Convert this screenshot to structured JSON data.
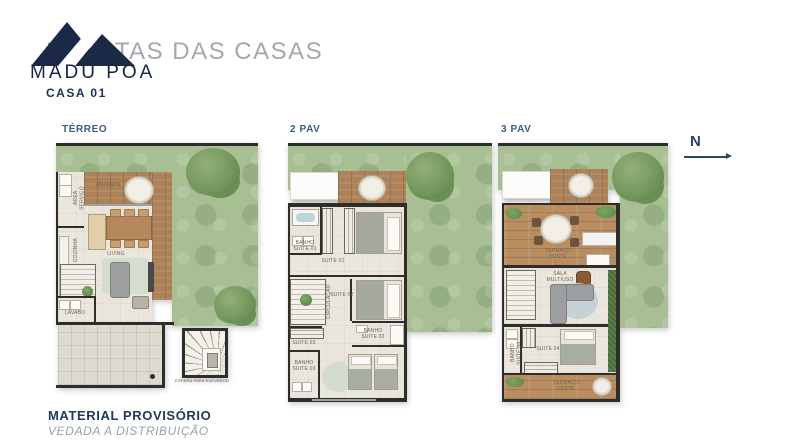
{
  "header": {
    "brand": "MADU POA",
    "title": "PLANTAS DAS CASAS",
    "unit": "CASA 01"
  },
  "compass": {
    "label": "N"
  },
  "footer": {
    "line1": "MATERIAL PROVISÓRIO",
    "line2": "VEDADA A DISTRIBUIÇÃO"
  },
  "plans": {
    "terreo": {
      "label": "TÉRREO",
      "rooms": {
        "area_servico": "ÁREA SERVIÇO",
        "cozinha": "COZINHA",
        "varanda": "VARANDA",
        "living": "LIVING",
        "lavabo": "LAVABO"
      },
      "note": "ESPERA PARA ELEVADOR"
    },
    "pav2": {
      "label": "2 PAV",
      "rooms": {
        "banho_suite_01": "BANHO SUITE 01",
        "suite_01": "SUITE 01",
        "circulacao": "CIRCULAÇÃO",
        "suite_02": "SUITE 02",
        "banho_suite_02": "BANHO SUITE 02",
        "suite_03": "SUITE 03",
        "banho_suite_03": "BANHO SUITE 03"
      }
    },
    "pav3": {
      "label": "3 PAV",
      "rooms": {
        "terraco_oeste": "TERRAÇO OESTE",
        "sala_multiuso": "SALA MULTIUSO",
        "banho_suite_04": "BANHO SUITE 04",
        "suite_04": "SUITE 04",
        "terraco_leste": "TERRAÇO LESTE"
      }
    }
  },
  "colors": {
    "navy": "#1b2947",
    "title_gray": "#a4a7ac",
    "plan_label_blue": "#3c5a85",
    "footer_gray": "#94a0af",
    "grass": "#a7bf93",
    "deck_wood": "#ad8258",
    "terrace_wood": "#b98d60",
    "wall": "#2e2d2a"
  }
}
